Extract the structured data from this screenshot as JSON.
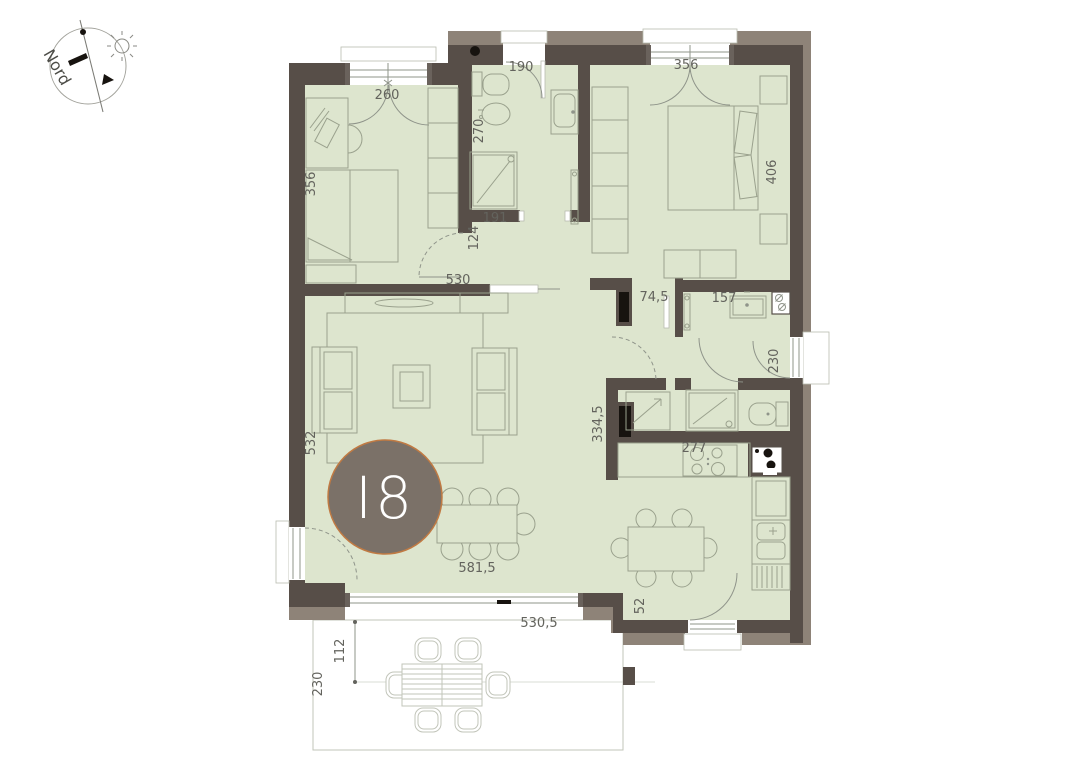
{
  "badge": {
    "label": "I8"
  },
  "compass": {
    "label": "Nord"
  },
  "colors": {
    "room_fill": "#dde5ce",
    "wall_dark": "#574e48",
    "wall_light": "#8e8378",
    "furniture_line": "#9aa18d",
    "dimension_text": "#63635d",
    "badge_fill": "#7b7168",
    "badge_ring": "#c07a43",
    "terrace_line": "#c2c5ba"
  },
  "dimensions": [
    {
      "text": "260",
      "x": 387,
      "y": 99,
      "rot": 0
    },
    {
      "text": "356",
      "x": 315,
      "y": 184,
      "rot": -90
    },
    {
      "text": "190",
      "x": 521,
      "y": 71,
      "rot": 0
    },
    {
      "text": "270",
      "x": 483,
      "y": 131,
      "rot": -90
    },
    {
      "text": "356",
      "x": 686,
      "y": 69,
      "rot": 0
    },
    {
      "text": "406",
      "x": 776,
      "y": 172,
      "rot": -90
    },
    {
      "text": "124",
      "x": 478,
      "y": 238,
      "rot": -90
    },
    {
      "text": "191",
      "x": 495,
      "y": 222,
      "rot": 0
    },
    {
      "text": "530",
      "x": 458,
      "y": 284,
      "rot": 0
    },
    {
      "text": "74,5",
      "x": 654,
      "y": 301,
      "rot": 0
    },
    {
      "text": "157",
      "x": 724,
      "y": 302,
      "rot": 0
    },
    {
      "text": "230",
      "x": 778,
      "y": 361,
      "rot": -90
    },
    {
      "text": "334,5",
      "x": 602,
      "y": 424,
      "rot": -90
    },
    {
      "text": "532",
      "x": 315,
      "y": 443,
      "rot": -90
    },
    {
      "text": "277",
      "x": 694,
      "y": 452,
      "rot": 0
    },
    {
      "text": "581,5",
      "x": 477,
      "y": 572,
      "rot": 0
    },
    {
      "text": "52",
      "x": 644,
      "y": 606,
      "rot": -90
    },
    {
      "text": "530,5",
      "x": 539,
      "y": 627,
      "rot": 0
    },
    {
      "text": "112",
      "x": 344,
      "y": 651,
      "rot": -90
    },
    {
      "text": "230",
      "x": 322,
      "y": 684,
      "rot": -90
    }
  ]
}
